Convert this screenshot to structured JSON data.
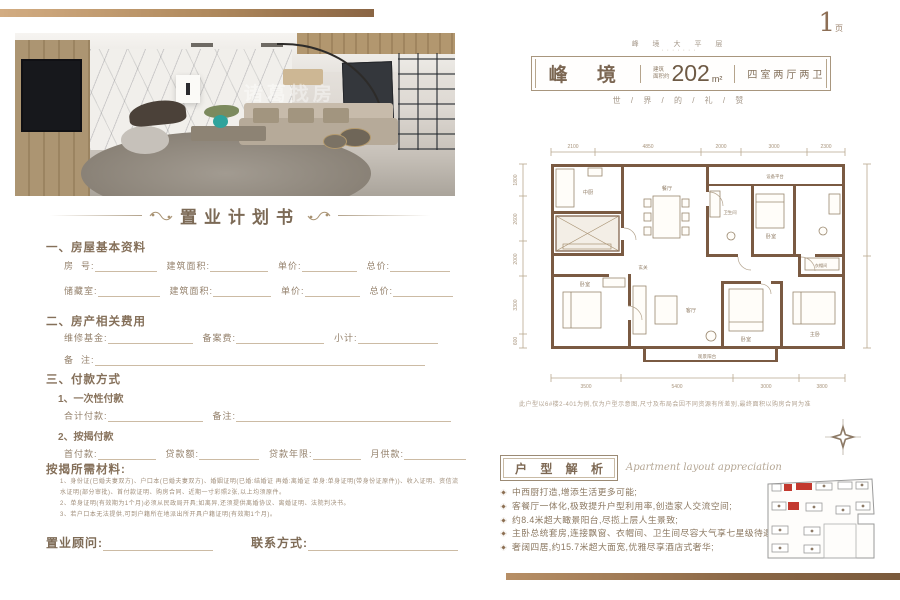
{
  "page": {
    "number": "1",
    "number_suffix": "页"
  },
  "watermark": "诸葛找房",
  "header": {
    "eyebrow": "峰 境 大 平 层",
    "eyebrow_dots": "·······",
    "title": "峰 境",
    "area_label_top": "建筑",
    "area_label_bottom": "面积约",
    "area_value": "202",
    "area_unit": "m²",
    "rooms": "四室两厅两卫",
    "tagline": "世 / 界 / 的 / 礼 / 赞"
  },
  "form": {
    "title": "置业计划书",
    "section1": {
      "heading": "一、房屋基本资料",
      "row1": [
        "房  号:",
        "建筑面积:",
        "单价:",
        "总价:"
      ],
      "row2": [
        "储藏室:",
        "建筑面积:",
        "单价:",
        "总价:"
      ]
    },
    "section2": {
      "heading": "二、房产相关费用",
      "row1": [
        "维修基金:",
        "备案费:",
        "小计:"
      ],
      "row2": [
        "备  注:"
      ]
    },
    "section3": {
      "heading": "三、付款方式",
      "sub1": "1、一次性付款",
      "sub1_row": [
        "合计付款:",
        "备注:"
      ],
      "sub2": "2、按揭付款",
      "sub2_row": [
        "首付款:",
        "贷款额:",
        "贷款年限:",
        "月供款:"
      ]
    },
    "materials": {
      "heading": "按揭所需材料:",
      "lines": [
        "1、身份证(已婚夫妻双方)、户口本(已婚夫妻双方)、婚姻证明(已婚:结婚证 再婚:离婚证 单身:单身证明(带身份证原件))、收入证明、资信流水证明(部分审批)、首付款证明、购房合同、近期一寸彩照2张,以上均须原件。",
        "2、单身证明(有效期为1个月)必须从民政局开具;如离异,还须提供离婚协议、离婚证明、法院判决书。",
        "3、若户口本无法提供,可到户籍所在地派出所开具户籍证明(有效期1个月)。"
      ]
    },
    "footer": {
      "consultant": "置业顾问:",
      "contact": "联系方式:"
    }
  },
  "floorplan": {
    "dims_top": [
      "2100",
      "4850",
      "2000",
      "3000",
      "2300"
    ],
    "dims_bottom": [
      "3500",
      "5400",
      "3000",
      "3800"
    ],
    "dims_left": [
      "1800",
      "2600",
      "2000",
      "3300",
      "600"
    ],
    "rooms": [
      {
        "name": "中厨"
      },
      {
        "name": "餐厅"
      },
      {
        "name": "设备平台"
      },
      {
        "name": "卫生间"
      },
      {
        "name": "卧室"
      },
      {
        "name": "玄关"
      },
      {
        "name": "客厅"
      },
      {
        "name": "卧室"
      },
      {
        "name": "卧室"
      },
      {
        "name": "主卧"
      },
      {
        "name": "衣帽间"
      },
      {
        "name": "观景阳台"
      }
    ],
    "note": "此户型以6#楼2-401为例,仅为户型示意图,尺寸及布局会因不同资源有所差别,最终面积以购房合同为准"
  },
  "analysis": {
    "title": "户 型 解 析",
    "subtitle": "Apartment layout appreciation",
    "bullets": [
      "中西厨打造,增添生活更多可能;",
      "客餐厅一体化,极致提升户型利用率,创造家人交流空间;",
      "约8.4米超大瞰景阳台,尽揽上层人生景致;",
      "主卧总统套房,连接飘窗、衣帽间、卫生间尽容大气享七星级待遇;",
      "奢阔四居,约15.7米超大面宽,优雅尽享酒店式奢华;"
    ]
  },
  "colors": {
    "accent_gold": "#b08a5e",
    "wall_brown": "#7a5a42",
    "highlight_red": "#c3392f"
  }
}
